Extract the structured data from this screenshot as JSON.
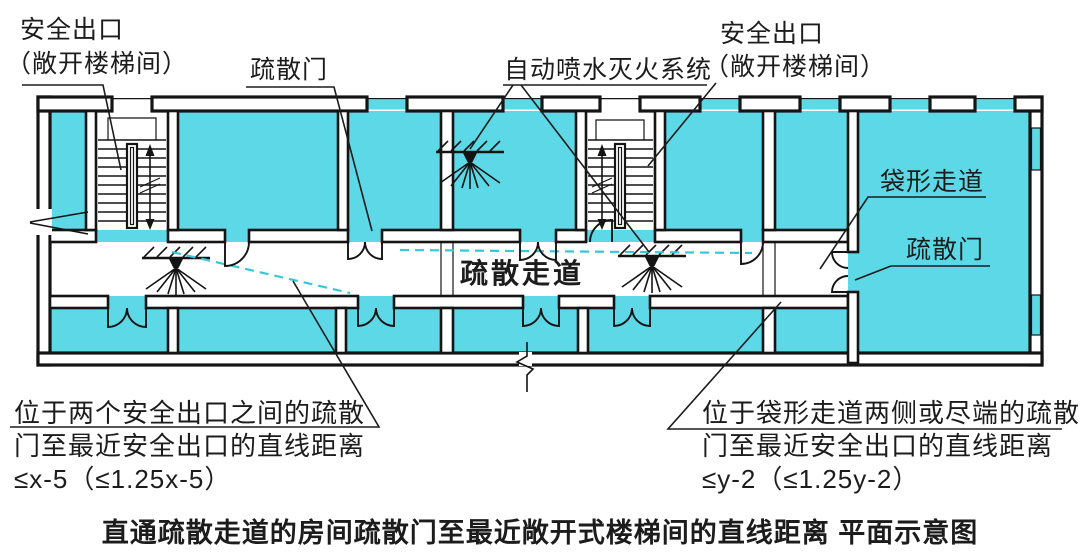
{
  "diagram": {
    "caption": "直通疏散走道的房间疏散门至最近敞开式楼梯间的直线距离 平面示意图",
    "labels": {
      "safety_exit_left_line1": "安全出口",
      "safety_exit_left_line2": "（敞开楼梯间）",
      "evac_door_top": "疏散门",
      "sprinkler_system": "自动喷水灭火系统",
      "safety_exit_right_line1": "安全出口",
      "safety_exit_right_line2": "（敞开楼梯间）",
      "dead_end_corridor": "袋形走道",
      "evac_door_right": "疏散门",
      "evac_corridor": "疏散走道"
    },
    "notes": {
      "between_exits": {
        "line1": "位于两个安全出口之间的疏散",
        "line2": "门至最近安全出口的直线距离",
        "line3": "≤x-5（≤1.25x-5）"
      },
      "dead_end": {
        "line1": "位于袋形走道两侧或尽端的疏散",
        "line2": "门至最近安全出口的直线距离",
        "line3": "≤y-2（≤1.25y-2）"
      }
    },
    "colors": {
      "room_fill": "#5cd8e6",
      "wall_line": "#141414",
      "travel_path_dash": "#38c7da",
      "text": "#1c1c1c",
      "background": "#ffffff"
    }
  }
}
